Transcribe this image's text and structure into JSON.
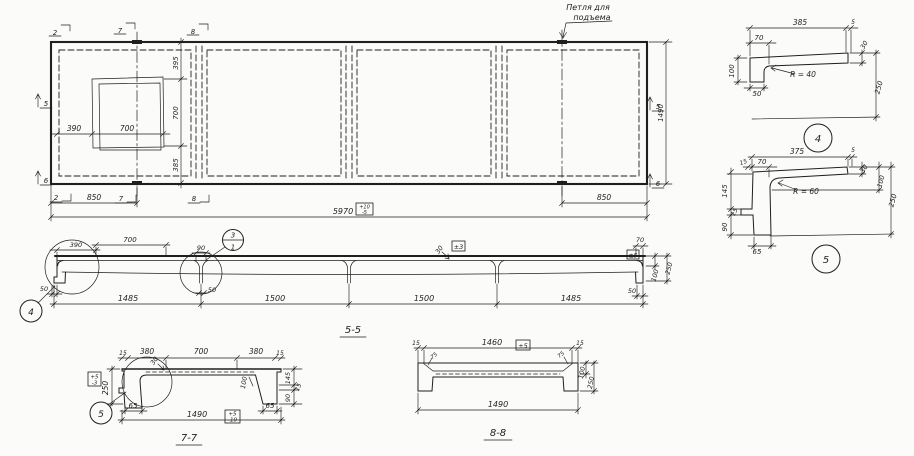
{
  "drawing": {
    "ink": "#1f1f1f",
    "paper": "#fbfbf9"
  },
  "plan": {
    "loop_label_line1": "Петля для",
    "loop_label_line2": "подъема",
    "marker_2": "2",
    "marker_7": "7",
    "marker_8": "8",
    "marker_5": "5",
    "marker_6": "6",
    "dim_395": "395",
    "dim_700_v": "700",
    "dim_385": "385",
    "dim_390": "390",
    "dim_700_h": "700",
    "dim_850_left": "850",
    "dim_850_right": "850",
    "dim_5970": "5970",
    "tol_5970_top": "+10",
    "tol_5970_bot": "-5",
    "dim_1490": "1490"
  },
  "s55": {
    "title": "5-5",
    "dim_390": "390",
    "dim_700": "700",
    "dim_90": "90",
    "balloon_top": "3",
    "balloon_bottom": "1",
    "tol_3": "±3",
    "dim_30": "30",
    "dim_70": "70",
    "tol_5": "±5",
    "dim_100": "100",
    "dim_250": "250",
    "dim_50_left": "50",
    "dim_50_notch": "50",
    "dim_50_right": "50",
    "dim_1485_left": "1485",
    "dim_1500_left": "1500",
    "dim_1500_right": "1500",
    "dim_1485_right": "1485",
    "detail_ref_4": "4"
  },
  "s77": {
    "title": "7-7",
    "dim_15_left": "15",
    "dim_380_left": "380",
    "dim_700": "700",
    "dim_380_right": "380",
    "dim_15_right": "15",
    "dim_30": "30",
    "dim_250": "250",
    "tol_250_top": "+5",
    "tol_250_bot": "-3",
    "dim_145": "145",
    "dim_15_side": "15",
    "dim_90": "90",
    "dim_100": "100",
    "dim_65_left": "65",
    "dim_65_right": "65",
    "dim_1490": "1490",
    "tol_1490_top": "+5",
    "tol_1490_bot": "-10",
    "detail_ref_5": "5"
  },
  "s88": {
    "title": "8-8",
    "dim_15_left": "15",
    "dim_1460": "1460",
    "tol_1460": "±5",
    "dim_15_right": "15",
    "dim_75_left": "75",
    "dim_75_right": "75",
    "dim_100": "100",
    "dim_250": "250",
    "dim_1490": "1490"
  },
  "d4": {
    "ref": "4",
    "dim_385": "385",
    "dim_5": "5",
    "dim_70": "70",
    "dim_100": "100",
    "radius": "R = 40",
    "dim_30": "30",
    "dim_250": "250",
    "dim_50": "50"
  },
  "d5": {
    "ref": "5",
    "dim_375": "375",
    "dim_5": "5",
    "dim_15_top": "15",
    "dim_70": "70",
    "dim_145": "145",
    "dim_15_side": "15",
    "dim_90": "90",
    "radius": "R = 60",
    "dim_30": "30",
    "dim_100": "100",
    "dim_250": "250",
    "dim_65": "65"
  }
}
